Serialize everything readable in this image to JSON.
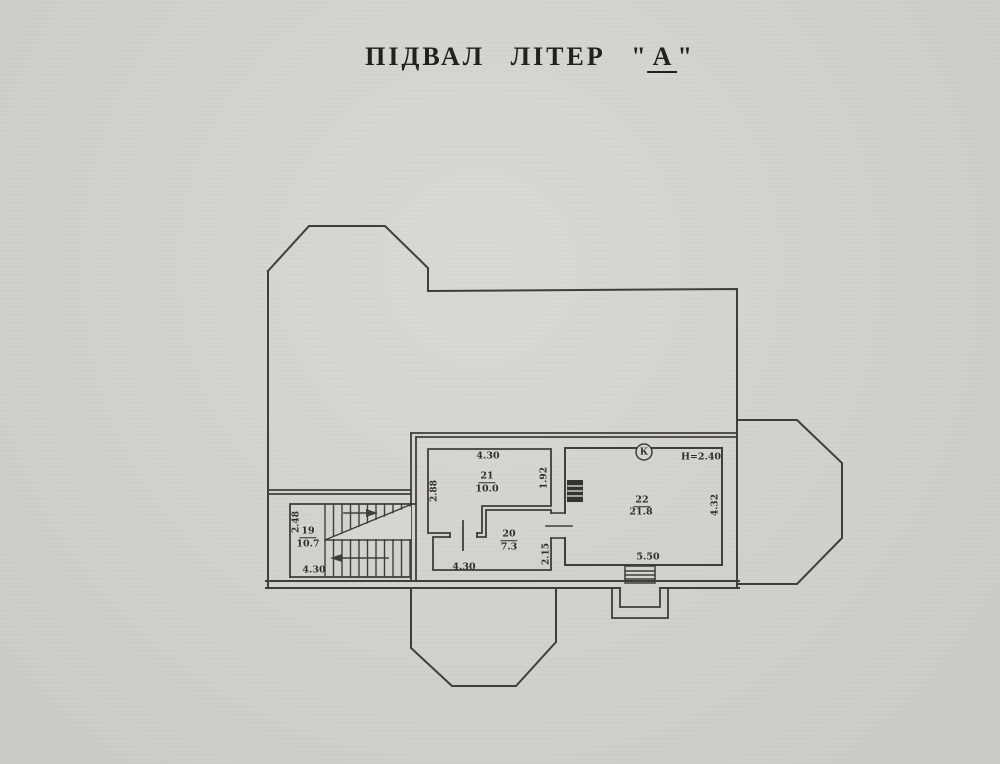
{
  "title": {
    "main": "ПІДВАЛ ЛІТЕР",
    "open_quote": "\"",
    "letter": "А",
    "close_quote": "\""
  },
  "plan": {
    "rooms": [
      {
        "number": "19",
        "area": "10.7"
      },
      {
        "number": "20",
        "area": "7.3"
      },
      {
        "number": "21",
        "area": "10.0"
      },
      {
        "number": "22",
        "area": "21.8"
      }
    ],
    "dims": {
      "room19_width_bottom": "4.30",
      "room19_depth_left": "2.48",
      "room20_width_bottom": "4.30",
      "room20_depth_right": "2.15",
      "room21_width_top": "4.30",
      "room21_depth_left": "2.88",
      "room21_depth_right": "1.92",
      "room22_width_bottom": "5.50",
      "room22_depth_right": "4.32",
      "ceiling_height_note": "Н=2.40"
    },
    "symbols": {
      "duct_letter": "К"
    }
  },
  "colors": {
    "paper": "#d6d5d1",
    "ink": "#403e3a"
  }
}
